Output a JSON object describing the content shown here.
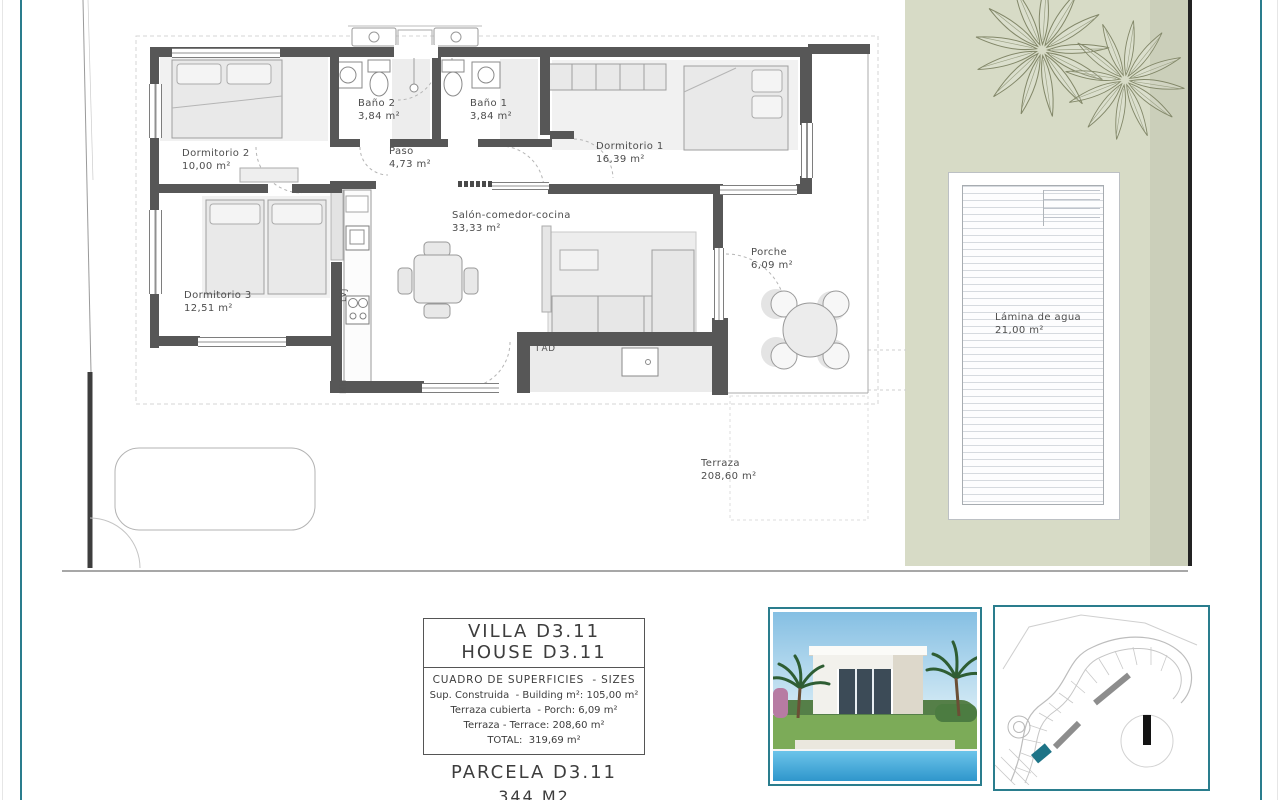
{
  "sheet": {
    "accent": "#2a7d8d",
    "garden_color": "#d7dbc6"
  },
  "plan": {
    "rooms": [
      {
        "name": "Dormitorio 2",
        "area": "10,00 m²"
      },
      {
        "name": "Baño 2",
        "area": "3,84 m²"
      },
      {
        "name": "Baño 1",
        "area": "3,84 m²"
      },
      {
        "name": "Paso",
        "area": "4,73 m²"
      },
      {
        "name": "Dormitorio 1",
        "area": "16,39 m²"
      },
      {
        "name": "Dormitorio 3",
        "area": "12,51 m²"
      },
      {
        "name": "Salón-comedor-cocina",
        "area": "33,33 m²"
      },
      {
        "name": "Porche",
        "area": "6,09 m²"
      },
      {
        "name": "Terraza",
        "area": "208,60 m²"
      },
      {
        "name": "Lámina de agua",
        "area": "21,00 m²"
      }
    ],
    "fixtures": {
      "dishwasher": "LVJ",
      "oven": "MH",
      "laundry": "ΓAD"
    }
  },
  "summary": {
    "title1": "VILLA D3.11",
    "title2": "HOUSE D3.11",
    "header": "CUADRO DE SUPERFICIES  - SIZES",
    "rows": [
      "Sup. Construida  - Building m²: 105,00 m²",
      "Terraza cubierta  - Porch: 6,09 m²",
      "Terraza - Terrace: 208,60 m²",
      "TOTAL:  319,69 m²"
    ],
    "parcel": "PARCELA D3.11",
    "parcel_area": "344 M2"
  }
}
